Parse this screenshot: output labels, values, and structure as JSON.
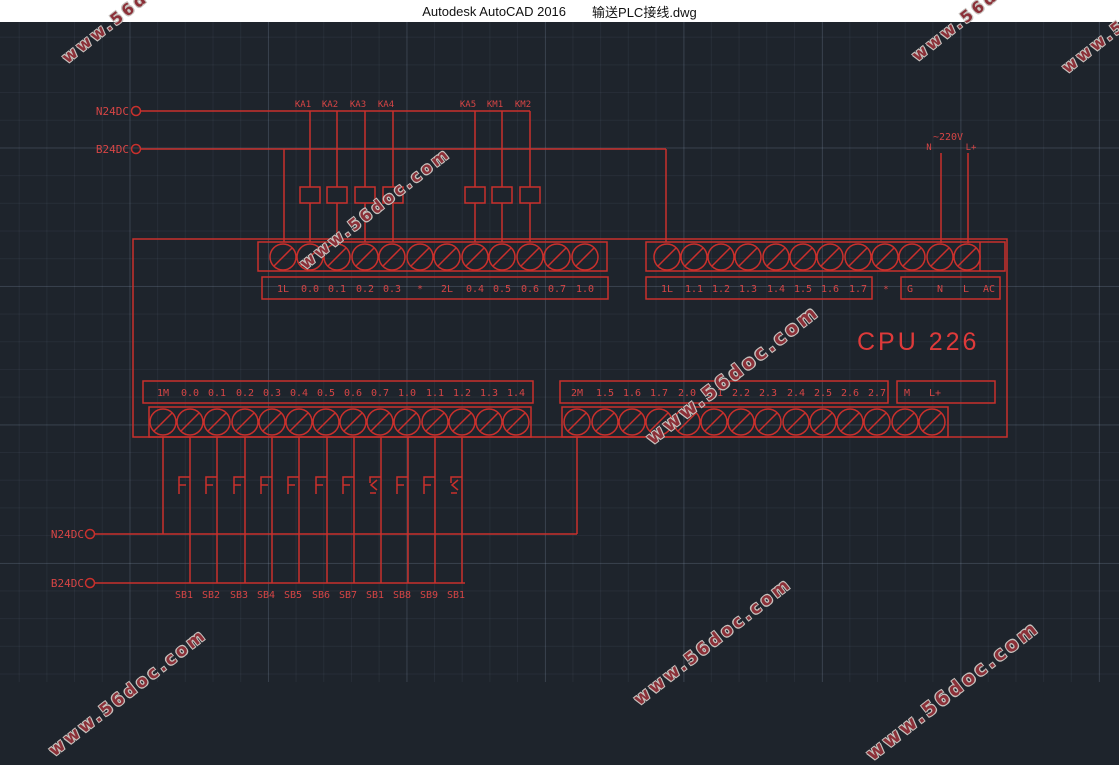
{
  "window": {
    "title_app": "Autodesk AutoCAD 2016",
    "title_file": "输送PLC接线.dwg"
  },
  "colors": {
    "canvas_bg": "#1e242c",
    "grid": "#2b333d",
    "line_red": "#c9302c",
    "text_red": "#d64545",
    "watermark_red": "#8b3038",
    "titlebar_bg": "#ffffff"
  },
  "watermark": {
    "text": "www.56doc.com"
  },
  "diagram": {
    "rails_top": {
      "n24dc": "N24DC",
      "b24dc": "B24DC"
    },
    "rails_bottom": {
      "n24dc": "N24DC",
      "b24dc": "B24DC"
    },
    "relay_labels": [
      "KA1",
      "KA2",
      "KA3",
      "KA4",
      "KA5",
      "KM1",
      "KM2"
    ],
    "power": {
      "voltage": "~220V",
      "n": "N",
      "lplus": "L+"
    },
    "cpu_label": "CPU 226",
    "top_left_terminals": [
      "1L",
      "0.0",
      "0.1",
      "0.2",
      "0.3",
      "*",
      "2L",
      "0.4",
      "0.5",
      "0.6",
      "0.7",
      "1.0"
    ],
    "top_right_terminals": [
      "1L",
      "1.1",
      "1.2",
      "1.3",
      "1.4",
      "1.5",
      "1.6",
      "1.7"
    ],
    "top_right_star": "*",
    "top_right_power_terminals": [
      "G",
      "N",
      "L",
      "AC"
    ],
    "bottom_left_terminals": [
      "1M",
      "0.0",
      "0.1",
      "0.2",
      "0.3",
      "0.4",
      "0.5",
      "0.6",
      "0.7",
      "1.0",
      "1.1",
      "1.2",
      "1.3",
      "1.4"
    ],
    "bottom_right_terminals": [
      "2M",
      "1.5",
      "1.6",
      "1.7",
      "2.0",
      "2.1",
      "2.2",
      "2.3",
      "2.4",
      "2.5",
      "2.6",
      "2.7"
    ],
    "bottom_right_power_terminals": [
      "M",
      "L+"
    ],
    "button_labels": [
      "SB1",
      "SB2",
      "SB3",
      "SB4",
      "SB5",
      "SB6",
      "SB7",
      "SB1",
      "SB8",
      "SB9",
      "SB1"
    ]
  }
}
